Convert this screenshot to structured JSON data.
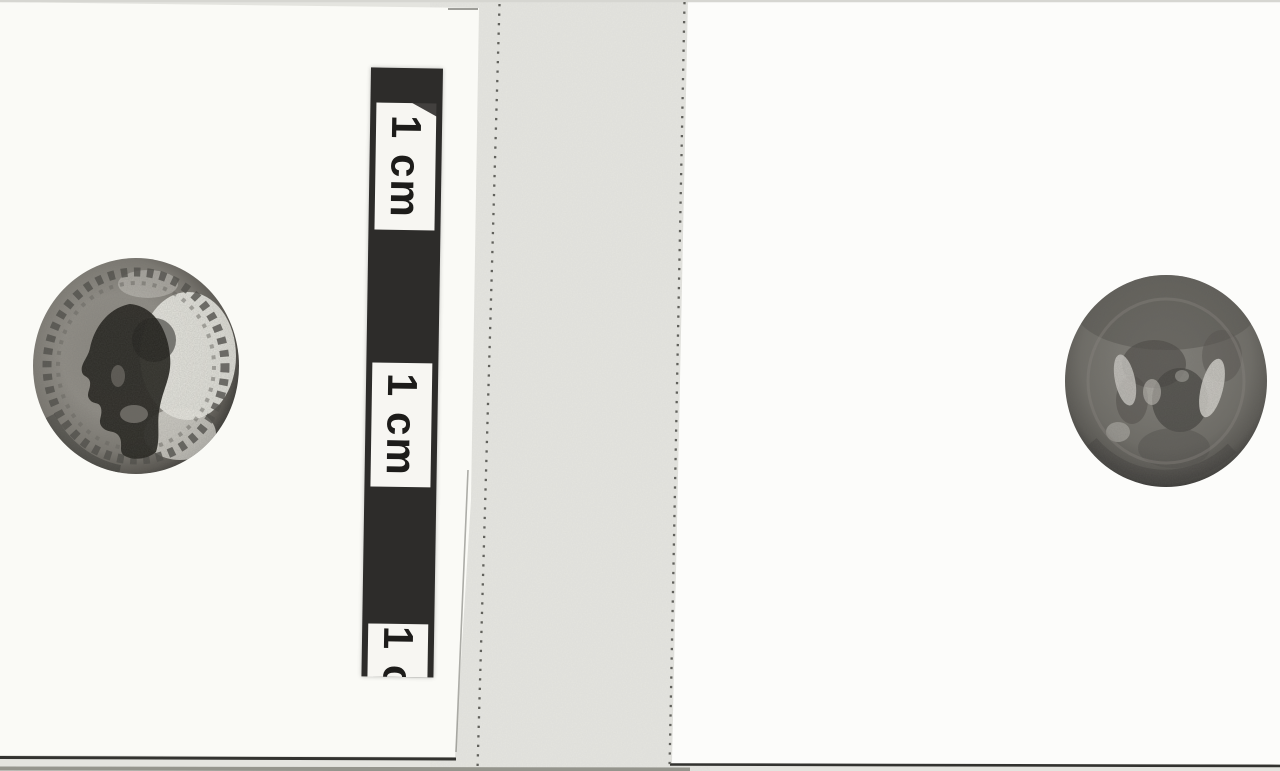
{
  "scale_bar": {
    "labels": [
      "1 cm",
      "1 cm",
      "1 c"
    ]
  },
  "figures": {
    "left_coin": "coin-obverse-bust-facing-left-with-beaded-border",
    "right_coin": "coin-reverse-worn-relief"
  },
  "colors": {
    "gutter": "#e4e4df",
    "left_panel": "#fafaf6",
    "right_panel": "#fcfcfa",
    "ruler_dark": "#2d2c2a",
    "ruler_cell": "#f7f6f2",
    "ruler_text": "#1d1c1a",
    "stitch_dots": "#61615c",
    "edge_line": "#32322f",
    "bottom_band": "#95958d"
  }
}
